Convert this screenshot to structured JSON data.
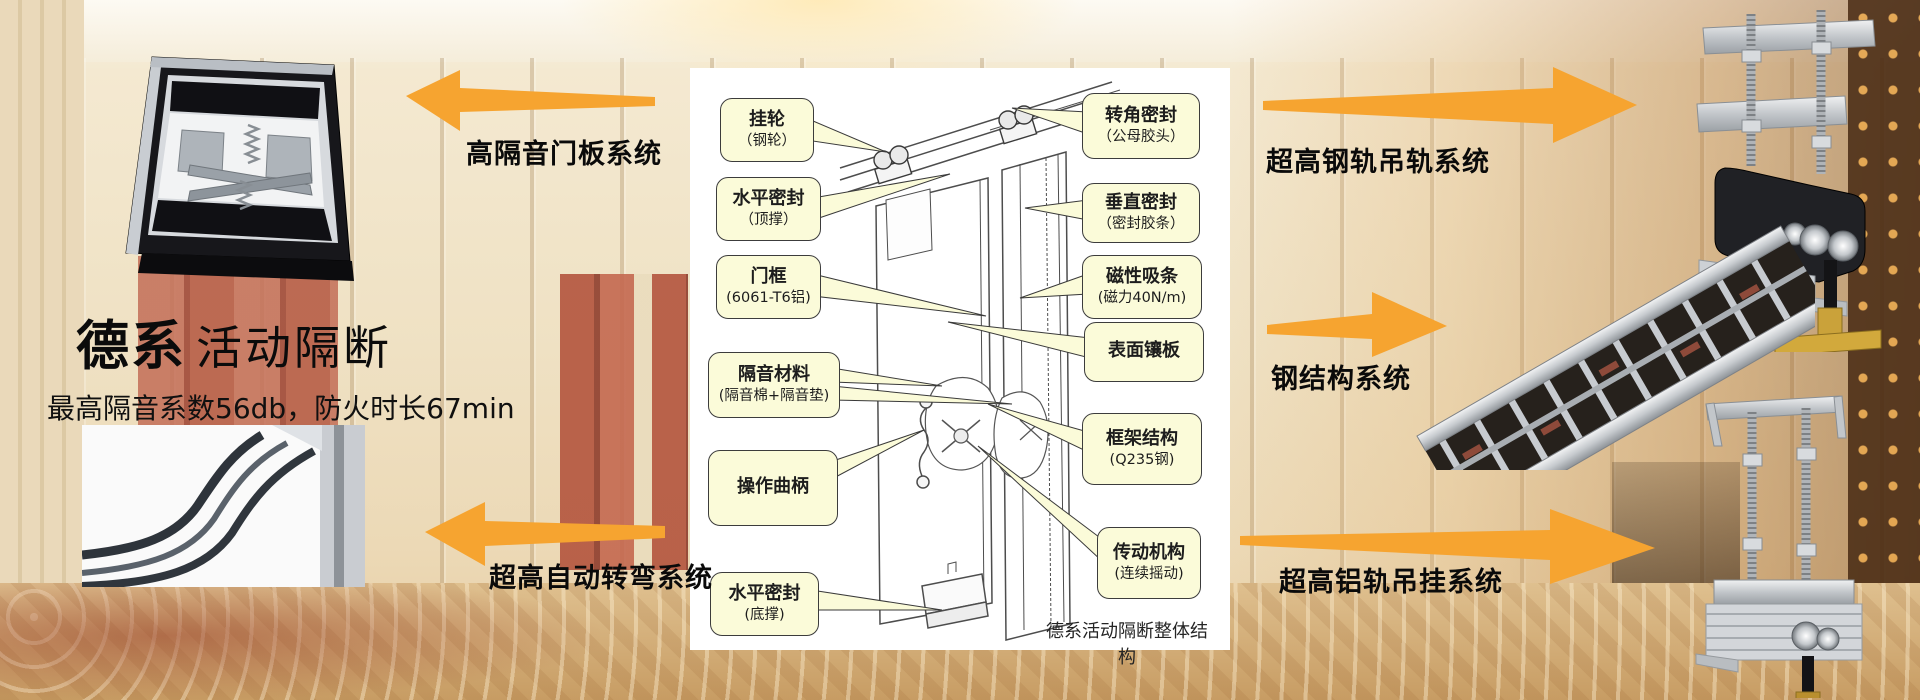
{
  "header": {
    "title_bold": "德系",
    "title_light": "活动隔断",
    "subtitle": "最高隔音系数56db，防火时长67min"
  },
  "system_labels": {
    "left_top": "高隔音门板系统",
    "left_bottom": "超高自动转弯系统",
    "right_top": "超高钢轨吊轨系统",
    "right_middle": "钢结构系统",
    "right_bottom": "超高铝轨吊挂系统"
  },
  "diagram": {
    "caption": "德系活动隔断整体结构",
    "callouts_left": [
      {
        "line1": "挂轮",
        "line2": "（钢轮）"
      },
      {
        "line1": "水平密封",
        "line2": "（顶撑）"
      },
      {
        "line1": "门框",
        "line2": "(6061-T6铝)"
      },
      {
        "line1": "隔音材料",
        "line2": "(隔音棉+隔音垫)"
      },
      {
        "line1": "操作曲柄",
        "line2": ""
      },
      {
        "line1": "水平密封",
        "line2": "(底撑)"
      }
    ],
    "callouts_right": [
      {
        "line1": "转角密封",
        "line2": "（公母胶头）"
      },
      {
        "line1": "垂直密封",
        "line2": "（密封胶条）"
      },
      {
        "line1": "磁性吸条",
        "line2": "(磁力40N/m)"
      },
      {
        "line1": "表面镶板",
        "line2": ""
      },
      {
        "line1": "框架结构",
        "line2": "(Q235钢)"
      },
      {
        "line1": "传动机构",
        "line2": "(连续摇动)"
      }
    ]
  },
  "colors": {
    "arrow_orange": "#F6A430",
    "callout_bg": "#FBFBD9",
    "callout_border": "#3C3C3C",
    "label_text": "#0A0A0A",
    "diagram_bg": "#FFFFFF"
  }
}
